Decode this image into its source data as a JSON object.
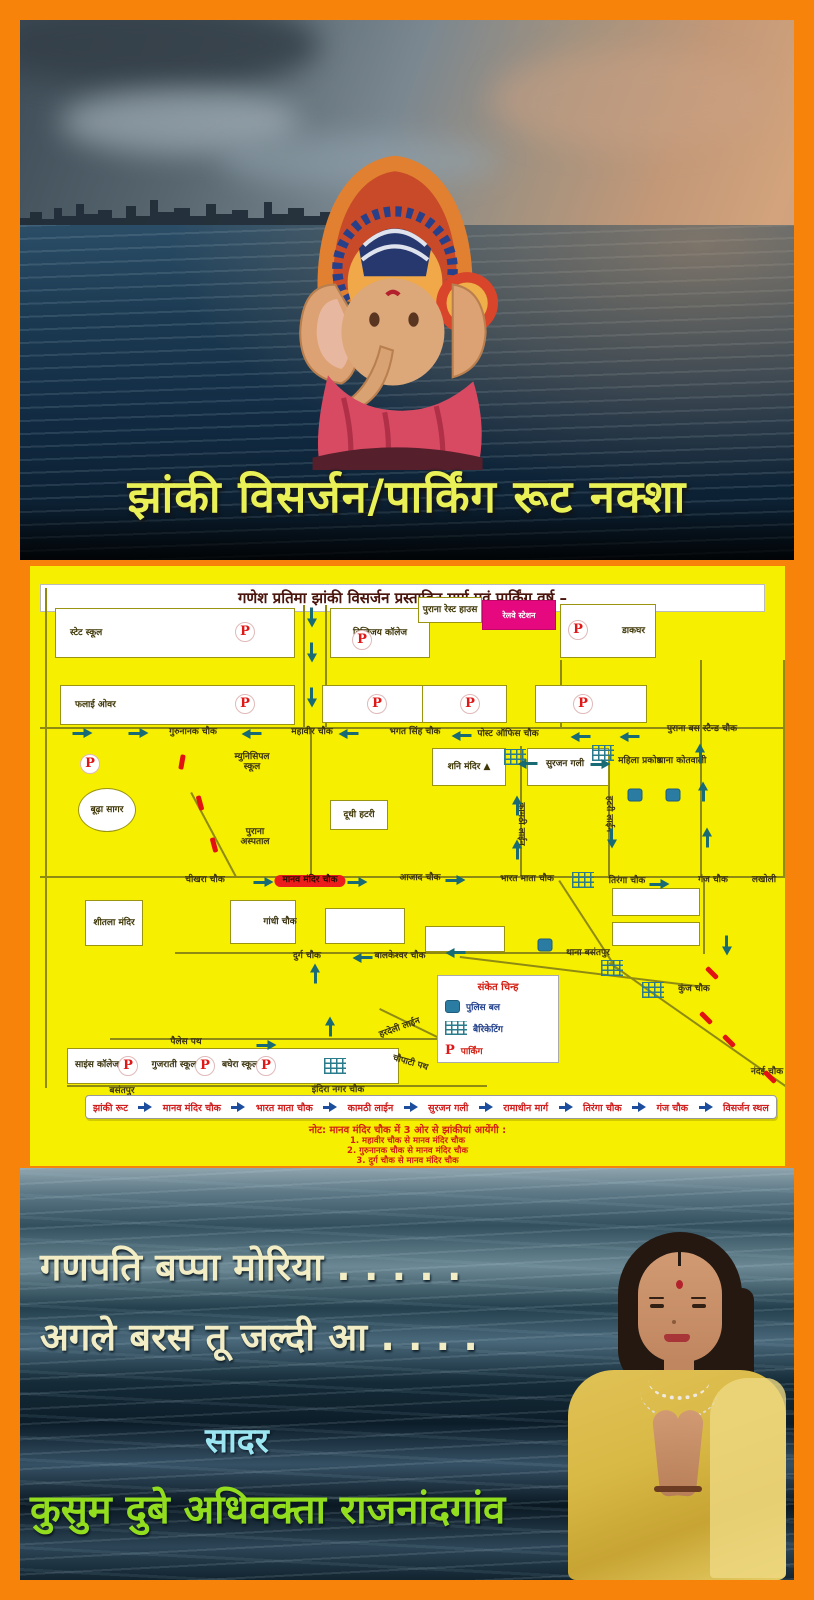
{
  "poster_title": "झांकी विसर्जन/पार्किंग रूट नक्शा",
  "map": {
    "title": "गणेश प्रतिमा झांकी विसर्जन प्रस्तावित मार्ग एवं पार्किंग वर्ष –",
    "railway_box": {
      "label": "रेलवे स्टेशन",
      "x": 452,
      "y": 34,
      "w": 74,
      "h": 30
    },
    "legend": {
      "title": "संकेत चिन्ह",
      "police": "पुलिस बल",
      "barricading": "बैरिकेटिंग",
      "parking": "पार्किंग"
    },
    "route_bar": [
      "झांकी रूट",
      "मानव मंदिर चौक",
      "भारत माता चौक",
      "कामठी लाईन",
      "सुरजन गली",
      "रामाधीन मार्ग",
      "तिरंगा चौक",
      "गंज चौक",
      "विसर्जन स्थल"
    ],
    "note": {
      "title": "नोट: मानव मंदिर चौक में 3 ओर से झांकीयां आयेंगी :",
      "items": [
        "1. महावीर चौक से मानव मंदिर चौक",
        "2. गुरुनानक चौक से मानव मंदिर चौक",
        "3. दुर्ग चौक से मानव मंदिर चौक"
      ]
    },
    "buildings": [
      {
        "label": "स्टेट स्कूल",
        "x": 25,
        "y": 42,
        "w": 240,
        "h": 50,
        "lx": "left"
      },
      {
        "label": "दिग्विजय कॉलेज",
        "x": 300,
        "y": 42,
        "w": 100,
        "h": 50
      },
      {
        "label": "पुराना रेस्ट हाउस",
        "x": 388,
        "y": 31,
        "w": 64,
        "h": 26
      },
      {
        "label": "डाकघर",
        "x": 530,
        "y": 38,
        "w": 96,
        "h": 54,
        "lx": "right"
      },
      {
        "label": "फलाई ओवर",
        "x": 30,
        "y": 119,
        "w": 235,
        "h": 40,
        "lx": "left"
      },
      {
        "x": 292,
        "y": 119,
        "w": 108,
        "h": 38
      },
      {
        "x": 392,
        "y": 119,
        "w": 85,
        "h": 38
      },
      {
        "x": 505,
        "y": 119,
        "w": 112,
        "h": 38
      },
      {
        "label": "शनि मंदिर ▲",
        "x": 402,
        "y": 182,
        "w": 74,
        "h": 38
      },
      {
        "x": 497,
        "y": 182,
        "w": 82,
        "h": 38
      },
      {
        "label": "दूधी हटरी",
        "x": 300,
        "y": 234,
        "w": 58,
        "h": 30
      },
      {
        "label": "शीतला मंदिर",
        "x": 55,
        "y": 334,
        "w": 58,
        "h": 46
      },
      {
        "x": 200,
        "y": 334,
        "w": 66,
        "h": 44
      },
      {
        "x": 295,
        "y": 342,
        "w": 80,
        "h": 36
      },
      {
        "x": 395,
        "y": 360,
        "w": 80,
        "h": 26
      },
      {
        "x": 582,
        "y": 322,
        "w": 88,
        "h": 28
      },
      {
        "x": 582,
        "y": 356,
        "w": 88,
        "h": 24
      },
      {
        "x": 37,
        "y": 482,
        "w": 332,
        "h": 36
      },
      {
        "label": "बूढ़ा सागर",
        "x": 48,
        "y": 222,
        "w": 58,
        "h": 44,
        "ellipse": true
      }
    ],
    "labels": [
      {
        "t": "गुरुनानक चौक",
        "x": 163,
        "y": 167
      },
      {
        "t": "महावीर चौक",
        "x": 282,
        "y": 167
      },
      {
        "t": "भगत सिंह चौक",
        "x": 385,
        "y": 167
      },
      {
        "t": "पोस्ट ऑफिस चौक",
        "x": 478,
        "y": 169
      },
      {
        "t": "पुराना बस स्टैन्ड चौक",
        "x": 672,
        "y": 164
      },
      {
        "t": "सुरजन गली",
        "x": 535,
        "y": 199
      },
      {
        "t": "म्युनिसिपल स्कूल",
        "x": 222,
        "y": 197,
        "s": "two"
      },
      {
        "t": "महिला प्रकोष्ठ",
        "x": 610,
        "y": 196,
        "s": "two"
      },
      {
        "t": "थाना कोतवाली",
        "x": 652,
        "y": 196,
        "s": "two"
      },
      {
        "t": "पुराना अस्पताल",
        "x": 225,
        "y": 272,
        "s": "two"
      },
      {
        "t": "कामठी लाईन",
        "x": 490,
        "y": 258,
        "s": "vert"
      },
      {
        "t": "हटरी लाईन",
        "x": 578,
        "y": 248,
        "s": "vert"
      },
      {
        "t": "चीखरा चौक",
        "x": 175,
        "y": 315
      },
      {
        "t": "मानव मंदिर चौक",
        "x": 280,
        "y": 315,
        "s": "hl"
      },
      {
        "t": "आजाद चौक",
        "x": 390,
        "y": 313
      },
      {
        "t": "भारत माता चौक",
        "x": 497,
        "y": 314
      },
      {
        "t": "तिरंगा चौक",
        "x": 597,
        "y": 316
      },
      {
        "t": "गंज चौक",
        "x": 683,
        "y": 315
      },
      {
        "t": "लखोली",
        "x": 734,
        "y": 315
      },
      {
        "t": "गांधी चौक",
        "x": 250,
        "y": 357
      },
      {
        "t": "दुर्ग चौक",
        "x": 277,
        "y": 391
      },
      {
        "t": "बालकेश्वर चौक",
        "x": 370,
        "y": 391
      },
      {
        "t": "थाना बसंतपुर",
        "x": 558,
        "y": 388,
        "s": "two"
      },
      {
        "t": "कुंज चौक",
        "x": 664,
        "y": 424
      },
      {
        "t": "नंदई चौक",
        "x": 737,
        "y": 507
      },
      {
        "t": "पैलेस पथ",
        "x": 156,
        "y": 477
      },
      {
        "t": "हरदेली लाईन",
        "x": 370,
        "y": 463,
        "s": "diag"
      },
      {
        "t": "चौपाटी पथ",
        "x": 380,
        "y": 498,
        "s": "diag2"
      },
      {
        "t": "बसंतपुर",
        "x": 92,
        "y": 526
      },
      {
        "t": "इंदिरा नगर चौक",
        "x": 308,
        "y": 525
      },
      {
        "t": "साइंस कॉलेज",
        "x": 67,
        "y": 500,
        "s": "two"
      },
      {
        "t": "गुजराती स्कूल",
        "x": 144,
        "y": 500,
        "s": "two"
      },
      {
        "t": "बघेरा स्कूल",
        "x": 210,
        "y": 500,
        "s": "two"
      }
    ],
    "parking": [
      [
        215,
        66
      ],
      [
        332,
        74
      ],
      [
        548,
        64
      ],
      [
        215,
        138
      ],
      [
        347,
        138
      ],
      [
        440,
        138
      ],
      [
        553,
        138
      ],
      [
        60,
        198
      ],
      [
        98,
        500
      ],
      [
        175,
        500
      ],
      [
        236,
        500
      ]
    ],
    "arrows": {
      "down": [
        [
          282,
          51
        ],
        [
          282,
          86
        ],
        [
          282,
          131
        ],
        [
          582,
          272
        ],
        [
          697,
          379
        ]
      ],
      "up": [
        [
          487,
          240
        ],
        [
          487,
          284
        ],
        [
          670,
          188
        ],
        [
          673,
          226
        ],
        [
          677,
          272
        ],
        [
          285,
          408
        ],
        [
          300,
          461
        ]
      ],
      "right": [
        [
          52,
          167
        ],
        [
          108,
          167
        ],
        [
          233,
          316
        ],
        [
          327,
          316
        ],
        [
          425,
          314
        ],
        [
          629,
          318
        ],
        [
          570,
          198
        ],
        [
          236,
          479
        ]
      ],
      "left": [
        [
          222,
          168
        ],
        [
          319,
          168
        ],
        [
          432,
          170
        ],
        [
          551,
          171
        ],
        [
          600,
          171
        ],
        [
          498,
          198
        ],
        [
          333,
          392
        ],
        [
          426,
          387
        ]
      ]
    },
    "red_dashes": [
      [
        152,
        196,
        100
      ],
      [
        170,
        237,
        75
      ],
      [
        184,
        279,
        75
      ],
      [
        682,
        407,
        45
      ],
      [
        676,
        452,
        45
      ],
      [
        699,
        475,
        45
      ],
      [
        740,
        511,
        45
      ]
    ],
    "police": [
      [
        605,
        229
      ],
      [
        643,
        229
      ],
      [
        515,
        379
      ]
    ],
    "barricades": [
      [
        485,
        191
      ],
      [
        573,
        187
      ],
      [
        553,
        314
      ],
      [
        582,
        402
      ],
      [
        623,
        424
      ],
      [
        305,
        500
      ]
    ],
    "roads": [
      [
        10,
        161,
        745,
        2,
        0
      ],
      [
        10,
        310,
        748,
        2,
        0
      ],
      [
        145,
        386,
        420,
        2,
        0
      ],
      [
        80,
        472,
        340,
        2,
        0
      ],
      [
        37,
        519,
        420,
        2,
        0
      ],
      [
        273,
        39,
        2,
        124,
        0
      ],
      [
        295,
        39,
        2,
        124,
        0
      ],
      [
        280,
        163,
        2,
        149,
        0
      ],
      [
        490,
        180,
        2,
        132,
        0
      ],
      [
        530,
        94,
        2,
        69,
        0
      ],
      [
        578,
        190,
        2,
        122,
        0
      ],
      [
        670,
        94,
        2,
        218,
        0
      ],
      [
        673,
        312,
        2,
        76,
        0
      ],
      [
        15,
        22,
        2,
        500,
        0
      ],
      [
        753,
        94,
        2,
        218,
        0
      ],
      [
        530,
        314,
        105,
        2,
        57
      ],
      [
        580,
        396,
        240,
        2,
        35
      ],
      [
        162,
        226,
        95,
        2,
        62
      ],
      [
        350,
        442,
        120,
        2,
        26
      ],
      [
        430,
        390,
        240,
        2,
        7
      ]
    ]
  },
  "footer": {
    "chant_line1": "गणपति बप्पा मोरिया . . . . .",
    "chant_line2": "अगले बरस तू जल्दी आ . . . .",
    "salute": "सादर",
    "author": "कुसुम दुबे अधिवक्ता राजनांदगांव"
  },
  "colors": {
    "frame_orange": "#f8830b",
    "map_yellow": "#f6ef00",
    "parking_red": "#e01818",
    "arrow_teal": "#186a74",
    "railway_magenta": "#e5087e",
    "route_text_red": "#cf1f1f",
    "note_red": "#d42014",
    "title_yellow": "#e9f157",
    "author_green": "#93dd1f",
    "salute_cyan": "#9ce6f2"
  }
}
